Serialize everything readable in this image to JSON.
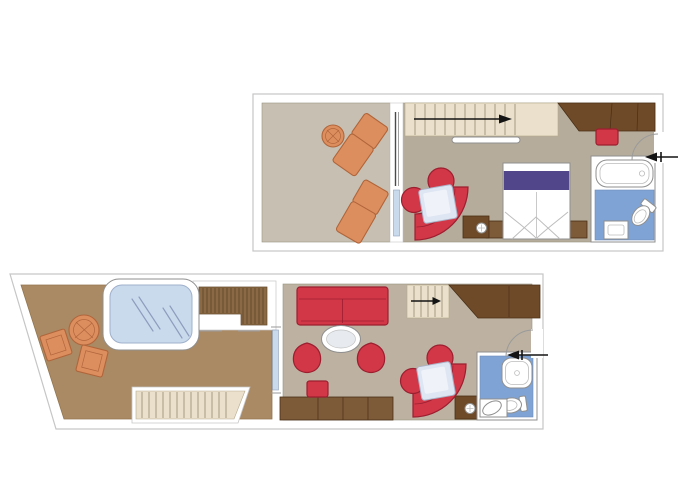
{
  "colors": {
    "white": "#ffffff",
    "wall-line": "#c6c6c6",
    "floor-balcony": "#c7c0b2",
    "floor-interior": "#b6ac9b",
    "floor-living": "#bdb2a1",
    "floor-terrace": "#aa8a64",
    "floor-edge": "#9a917f",
    "terrace-edge": "#93764e",
    "stair": "#ebe0cb",
    "stair-edge": "#b5a98e",
    "stair-line": "#a59a80",
    "wood-dark": "#6f4a28",
    "wood-mid": "#7d5a38",
    "wood-edge": "#4a2f15",
    "slat": "#8a6a44",
    "slat-line": "#66492b",
    "red": "#d23747",
    "red-dark": "#9c1f30",
    "orange": "#dd8e5f",
    "orange-dark": "#b0653a",
    "purple": "#514689",
    "blue-floor": "#7fa3d4",
    "blue-floor-edge": "#6b8cb8",
    "blue-water": "#cadaed",
    "water-edge": "#9fb0cb",
    "water-ref": "#8e9dbd",
    "blue-table": "#dfe6f3",
    "fixture-edge": "#8f8f8f",
    "arrow": "#141414"
  },
  "plans": {
    "upper": {
      "id": "upper-level",
      "rooms": [
        {
          "id": "balcony",
          "items": [
            "lounge-chair",
            "lounge-chair",
            "side-table",
            "sliding-door"
          ]
        },
        {
          "id": "bedroom",
          "items": [
            "staircase",
            "direction-arrow",
            "handrail",
            "wardrobe",
            "ottoman",
            "double-bed",
            "nightstand",
            "nightstand",
            "curved-sofa",
            "armchair",
            "pouf",
            "table",
            "media-cabinet"
          ]
        },
        {
          "id": "bathroom",
          "items": [
            "bathtub",
            "washbasin",
            "toilet"
          ]
        },
        {
          "id": "entry",
          "items": [
            "door-swing",
            "entry-arrow"
          ]
        }
      ]
    },
    "lower": {
      "id": "lower-level",
      "rooms": [
        {
          "id": "terrace",
          "items": [
            "whirlpool",
            "deck-stairs",
            "round-table",
            "chair",
            "chair",
            "steps"
          ]
        },
        {
          "id": "living-room",
          "items": [
            "sofa",
            "coffee-table",
            "tub-chair",
            "tub-chair",
            "desk",
            "stool",
            "staircase",
            "direction-arrow",
            "wardrobe",
            "curved-sofa",
            "armchair",
            "pouf",
            "table",
            "media-cabinet",
            "sliding-door"
          ]
        },
        {
          "id": "bathroom",
          "items": [
            "shower",
            "washbasin",
            "toilet"
          ]
        },
        {
          "id": "entry",
          "items": [
            "door-swing",
            "entry-arrow"
          ]
        }
      ]
    }
  }
}
